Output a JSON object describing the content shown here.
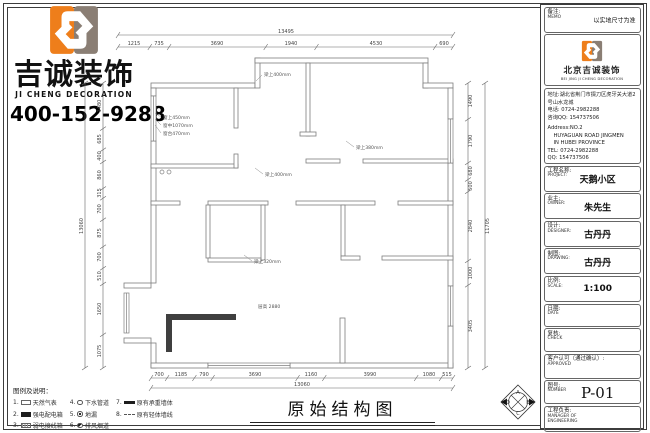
{
  "brand": {
    "name_cn": "吉诚装饰",
    "name_en": "JI CHENG DECORATION",
    "phone": "400-152-9288"
  },
  "drawing": {
    "title": "原始结构图",
    "dims": {
      "top": {
        "total": "13495",
        "segments": [
          "1215",
          "735",
          "3690",
          "1940",
          "4530",
          "690"
        ]
      },
      "bottom": {
        "total": "13060",
        "segments": [
          "700",
          "1185",
          "790",
          "3690",
          "1160",
          "3990",
          "1080",
          "515"
        ]
      },
      "left": {
        "total": "13060",
        "segments": [
          "1480",
          "685",
          "400",
          "860",
          "315",
          "700",
          "875",
          "700",
          "510",
          "1650",
          "1075"
        ]
      },
      "right": {
        "total": "11705",
        "segments": [
          "1490",
          "1790",
          "680",
          "500",
          "2840",
          "1000",
          "3405"
        ]
      }
    },
    "annotations": [
      "窗上450mm",
      "窗中1070mm",
      "窗台470mm",
      "梁上400mm",
      "梁上380mm",
      "梁上400mm",
      "梁上320mm",
      "层高 2880"
    ]
  },
  "compass": {
    "letters": [
      "A",
      "B",
      "C",
      "D"
    ]
  },
  "legend": {
    "title": "图例及说明：",
    "items": [
      {
        "no": "1.",
        "label": "天然气表"
      },
      {
        "no": "2.",
        "label": "强电配电箱"
      },
      {
        "no": "3.",
        "label": "弱电接线箱"
      },
      {
        "no": "4.",
        "label": "下水管道"
      },
      {
        "no": "5.",
        "label": "地漏"
      },
      {
        "no": "6.",
        "label": "排风烟道"
      },
      {
        "no": "7.",
        "label": "原有承重墙体"
      },
      {
        "no": "8.",
        "label": "原有轻体墙线"
      }
    ]
  },
  "title_block": {
    "memo_cn": "备注:",
    "memo_en": "MEMO",
    "memo_value": "以实地尺寸为准",
    "company_cn": "北京吉诚装饰",
    "company_en": "BEI JING JI CHENG DECORATION",
    "address_cn": "地址:湖北省荆门市掇刀区虎牙关大道2号山水龙城",
    "phone_cn": "电话: 0724-2982288",
    "qq_cn": "咨询QQ: 154737506",
    "address_en1": "Address:NO.2",
    "address_en2": "HUYAGUAN ROAD JINGMEN",
    "address_en3": "IN HUBEI PROVINCE",
    "tel_en": "TEL: 0724-2982288",
    "qq_en": "QQ: 154737506",
    "fields": [
      {
        "label_cn": "工程名称:",
        "label_en": "PROJECT:",
        "value": "天鹅小区"
      },
      {
        "label_cn": "业主:",
        "label_en": "OWNER:",
        "value": "朱先生"
      },
      {
        "label_cn": "设计:",
        "label_en": "DESIGNER:",
        "value": "古丹丹"
      },
      {
        "label_cn": "制图:",
        "label_en": "DRAWING:",
        "value": "古丹丹"
      },
      {
        "label_cn": "比例:",
        "label_en": "SCALE:",
        "value": "1:100"
      },
      {
        "label_cn": "日期:",
        "label_en": "DATE",
        "value": ""
      },
      {
        "label_cn": "复核:",
        "label_en": "CHECK",
        "value": ""
      },
      {
        "label_cn": "客户认可（通过确认）:",
        "label_en": "APPROVED",
        "value": ""
      },
      {
        "label_cn": "图号:",
        "label_en": "NUMBER",
        "value": "P-01"
      },
      {
        "label_cn": "工程负责:",
        "label_en": "MANAGER OF ENGINEERING",
        "value": ""
      }
    ],
    "colors": {
      "logo_orange": "#ee7e1b",
      "logo_gray": "#8a7e74"
    }
  }
}
